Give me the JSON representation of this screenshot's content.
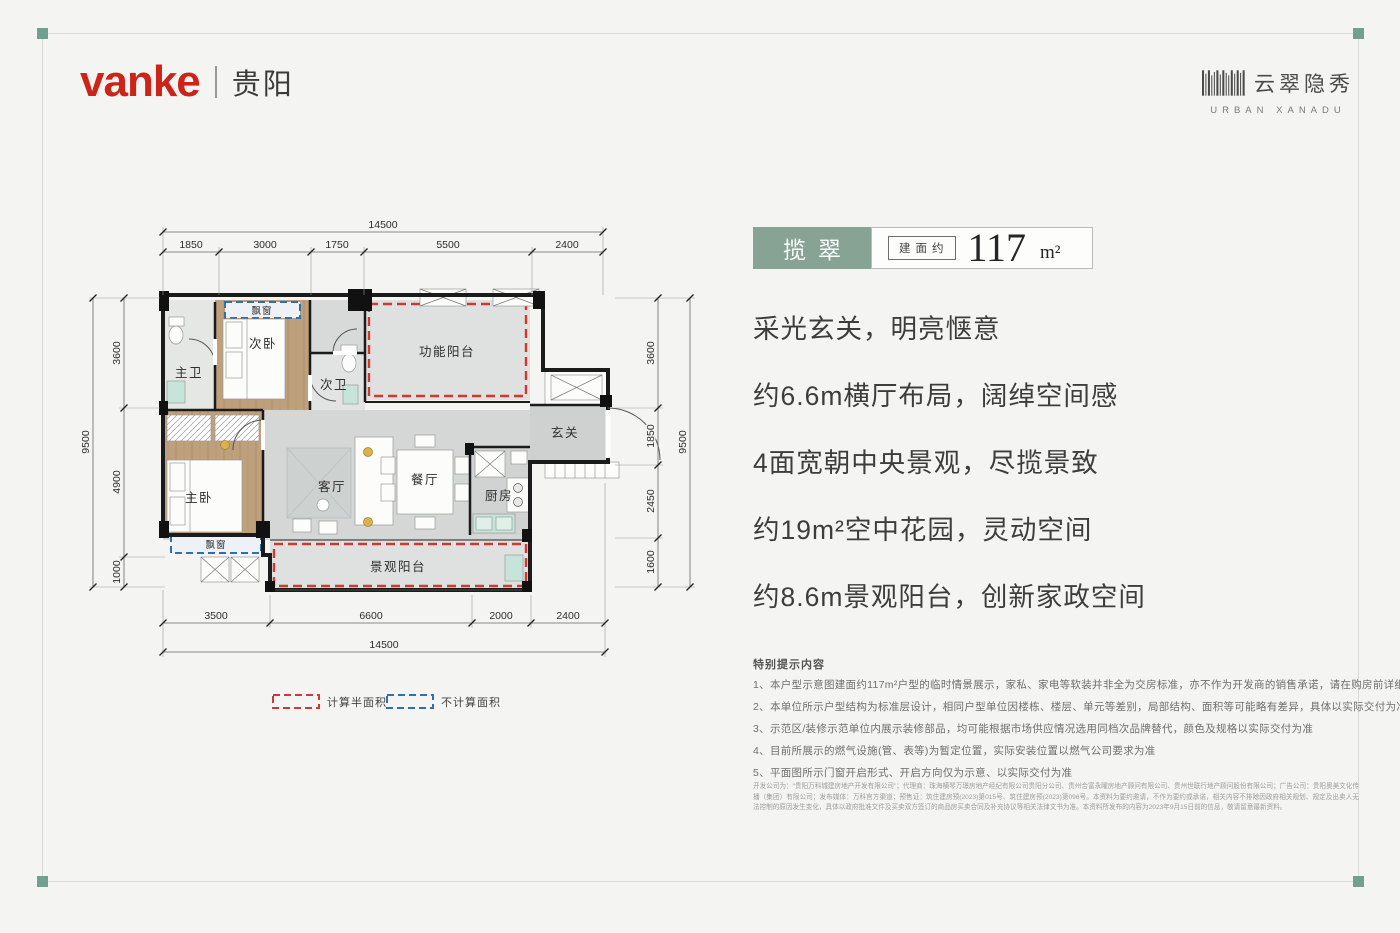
{
  "brand": {
    "logo": "vanke",
    "city": "贵阳",
    "project_cn": "云翠隐秀",
    "project_en": "URBAN XANADU"
  },
  "badge": {
    "name": "揽翠",
    "area_label": "建面约",
    "area_value": "117",
    "area_unit": "m²",
    "accent_color": "#87a394"
  },
  "selling_points": [
    "采光玄关，明亮惬意",
    "约6.6m横厅布局，阔绰空间感",
    "4面宽朝中央景观，尽揽景致",
    "约19m²空中花园，灵动空间",
    "约8.6m景观阳台，创新家政空间"
  ],
  "notes": {
    "title": "特别提示内容",
    "items": [
      "1、本户型示意图建面约117m²户型的临时情景展示，家私、家电等软装并非全为交房标准，亦不作为开发商的销售承诺，请在购房前详细了解“交付标准”",
      "2、本单位所示户型结构为标准层设计，相同户型单位因楼栋、楼层、单元等差别，局部结构、面积等可能略有差异，具体以实际交付为准",
      "3、示范区/装修示范单位内展示装修部品，均可能根据市场供应情况选用同档次品牌替代，颜色及规格以实际交付为准",
      "4、目前所展示的燃气设施(管、表等)为暂定位置，实际安装位置以燃气公司要求为准",
      "5、平面图所示门窗开启形式、开启方向仅为示意、以实际交付为准"
    ]
  },
  "legal": "开发公司为：“贵阳万科城建房地产开发有限公司”；代理商：珠海横琴万璟房地产经纪有限公司贵阳分公司、贵州合富永曜房地产顾问有限公司、贵州世联行地产顾问股份有限公司；广告公司：贵阳奥美文化传播（集团）有限公司；发布媒体：万科官方渠道；预售证：筑住建房预(2023)第015号、筑住建房预(2023)第096号。本资料为要约邀请，不作为要约或承诺，相关内容不排除因政府相关规划、规定及出卖人无法控制的原因发生变化，具体以政府批准文件及买卖双方签订的商品房买卖合同及补充协议等相关法律文书为准。本资料所发布的内容为2023年9月15日前的信息，敬请留意最新资料。",
  "floorplan": {
    "rooms": {
      "master_bath": "主卫",
      "bedroom2": "次卧",
      "bath2": "次卫",
      "function_balcony": "功能阳台",
      "foyer": "玄关",
      "master_bedroom": "主卧",
      "living": "客厅",
      "dining": "餐厅",
      "kitchen": "厨房",
      "vista_balcony": "景观阳台",
      "bay_window": "飘窗"
    },
    "dims": {
      "top": {
        "total": "14500",
        "segments": [
          "1850",
          "3000",
          "1750",
          "5500",
          "2400"
        ]
      },
      "bottom": {
        "total": "14500",
        "segments": [
          "3500",
          "6600",
          "2000",
          "2400"
        ]
      },
      "left": {
        "total": "9500",
        "segments": [
          "3600",
          "4900",
          "1000"
        ]
      },
      "right": {
        "total": "9500",
        "segments": [
          "3600",
          "1850",
          "2450",
          "1600"
        ]
      }
    },
    "legend": [
      {
        "label": "计算半面积",
        "color": "#cc3a33"
      },
      {
        "label": "不计算面积",
        "color": "#2f6fae"
      }
    ]
  }
}
